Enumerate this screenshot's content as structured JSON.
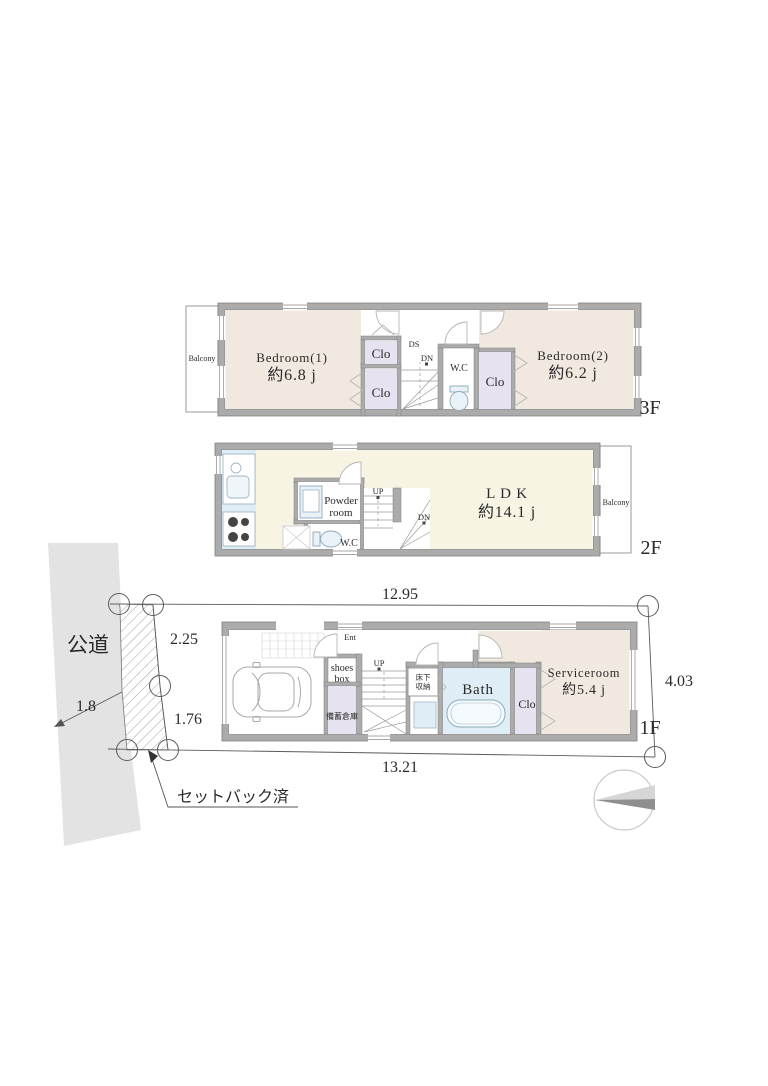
{
  "site": {
    "road_label": "公道",
    "road_width": "1.8",
    "dim_top": "12.95",
    "dim_bottom": "13.21",
    "dim_right": "4.03",
    "setback_dim1": "2.25",
    "setback_dim2": "1.76",
    "setback_note": "セットバック済"
  },
  "floor3": {
    "label": "3F",
    "balcony_label": "Balcony",
    "bedroom1_name": "Bedroom(1)",
    "bedroom1_size": "約6.8 j",
    "closet1_label": "Clo",
    "closet2_label": "Clo",
    "closet3_label": "Clo",
    "duct_label": "DS",
    "down_label": "DN",
    "wc_label": "W.C",
    "bedroom2_name": "Bedroom(2)",
    "bedroom2_size": "約6.2 j"
  },
  "floor2": {
    "label": "2F",
    "balcony_label": "Balcony",
    "ldk_name": "L D K",
    "ldk_size": "約14.1 j",
    "powder_line1": "Powder",
    "powder_line2": "room",
    "up_label": "UP",
    "down_label": "DN",
    "wc_label": "W.C"
  },
  "floor1": {
    "label": "1F",
    "ent_label": "Ent",
    "shoes_line1": "shoes",
    "shoes_line2": "box",
    "up_label": "UP",
    "underfloor_line1": "床下",
    "underfloor_line2": "収納",
    "bath_label": "Bath",
    "stock_label": "備蓄倉庫",
    "serviceroom_name": "Serviceroom",
    "serviceroom_size": "約5.4 j",
    "closet_label": "Clo"
  },
  "colors": {
    "wall": "#ababab",
    "bedroom_fill": "#f1e9e0",
    "ldk_fill": "#f8f4e4",
    "water_fill": "#dfeef6",
    "closet_fill": "#e6e2ef",
    "road_fill": "#e3e3e3"
  }
}
